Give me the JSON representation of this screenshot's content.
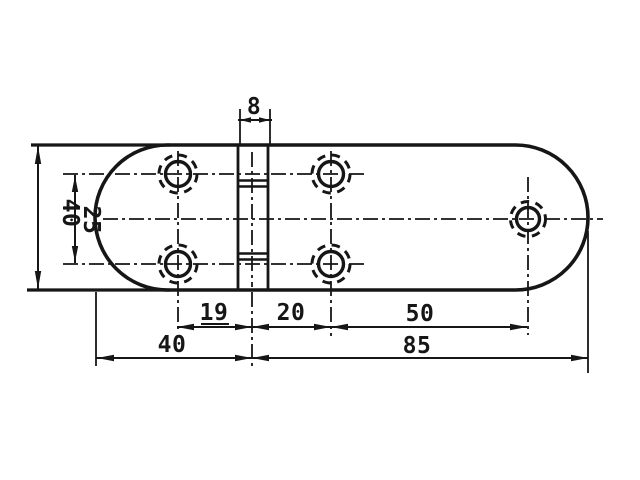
{
  "colors": {
    "ink": "#161616",
    "paper": "#ffffff"
  },
  "drawing": {
    "dimensions": {
      "pin_strip_width": "8",
      "plate_height": "40",
      "hole_row_spacing": "25",
      "left_holes_to_pin": "19",
      "pin_to_right_holes": "20",
      "right_holes_to_end_hole": "50",
      "left_leaf_length": "40",
      "right_leaf_length": "85"
    }
  }
}
